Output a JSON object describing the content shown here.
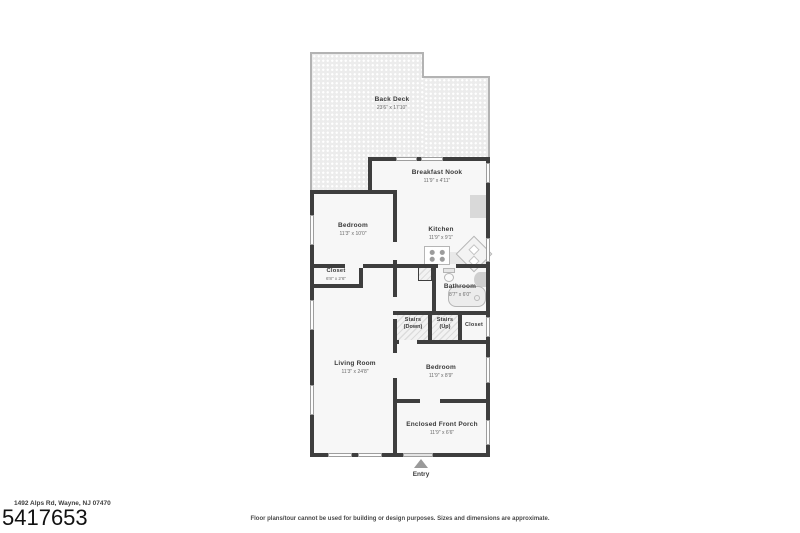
{
  "meta": {
    "address": "1492 Alps Rd, Wayne, NJ 07470",
    "mls_number": "5417653",
    "disclaimer": "Floor plans/tour cannot be used for building or design purposes. Sizes and dimensions are approximate."
  },
  "entry": {
    "label": "Entry"
  },
  "rooms": {
    "back_deck": {
      "name": "Back Deck",
      "dims": "23'6\" x 17'10\""
    },
    "breakfast_nook": {
      "name": "Breakfast Nook",
      "dims": "11'9\" x 4'11\""
    },
    "bedroom_1": {
      "name": "Bedroom",
      "dims": "11'3\" x 10'0\""
    },
    "kitchen": {
      "name": "Kitchen",
      "dims": "11'9\" x 9'1\""
    },
    "closet_1": {
      "name": "Closet",
      "dims": "6'8\" x 2'6\""
    },
    "bathroom": {
      "name": "Bathroom",
      "dims": "8'7\" x 6'0\""
    },
    "stairs_down": {
      "name": "Stairs",
      "dims": "(Down)"
    },
    "stairs_up": {
      "name": "Stairs",
      "dims": "(Up)"
    },
    "closet_hall": {
      "name": "Closet",
      "dims": ""
    },
    "living_room": {
      "name": "Living Room",
      "dims": "11'3\" x 24'8\""
    },
    "bedroom_2": {
      "name": "Bedroom",
      "dims": "11'9\" x 8'9\""
    },
    "front_porch": {
      "name": "Enclosed Front Porch",
      "dims": "11'9\" x 6'6\""
    }
  },
  "colors": {
    "wall": "#3e3e3e",
    "floor": "#f7f7f7",
    "deck": "#ececec",
    "deck_edge": "#b3b3b3",
    "fixture_outline": "#b5b5b5",
    "window_outline": "#9e9e9e"
  }
}
